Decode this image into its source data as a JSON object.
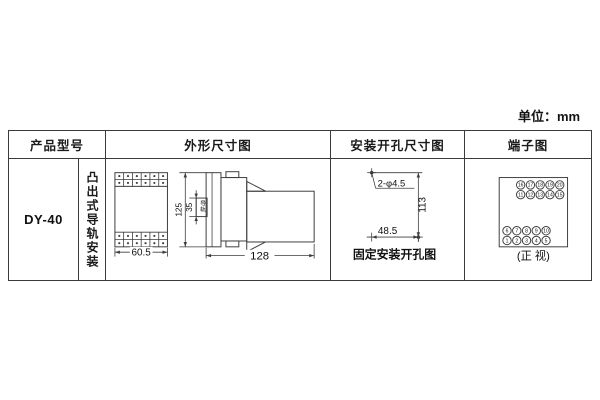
{
  "page": {
    "unit_label": "单位：mm"
  },
  "table": {
    "headers": {
      "product_model": "产品型号",
      "outline": "外形尺寸图",
      "mounting_holes": "安装开孔尺寸图",
      "terminals": "端子图"
    },
    "product_model": "DY-40",
    "mounting_type": "凸出式导轨安装"
  },
  "outline_drawing": {
    "width": "60.5",
    "height": "125",
    "rail_width": "35",
    "rail_label": "导轨",
    "depth": "128"
  },
  "holes_drawing": {
    "holes_label": "2-φ4.5",
    "height": "113",
    "width": "48.5",
    "caption": "固定安装开孔图"
  },
  "terminals_drawing": {
    "caption": "(正 视)",
    "top_row1": [
      "16",
      "17",
      "18",
      "19",
      "20"
    ],
    "top_row2": [
      "11",
      "12",
      "13",
      "14",
      "15"
    ],
    "bottom_row1": [
      "6",
      "7",
      "8",
      "9",
      "10"
    ],
    "bottom_row2": [
      "1",
      "2",
      "3",
      "4",
      "5"
    ]
  }
}
